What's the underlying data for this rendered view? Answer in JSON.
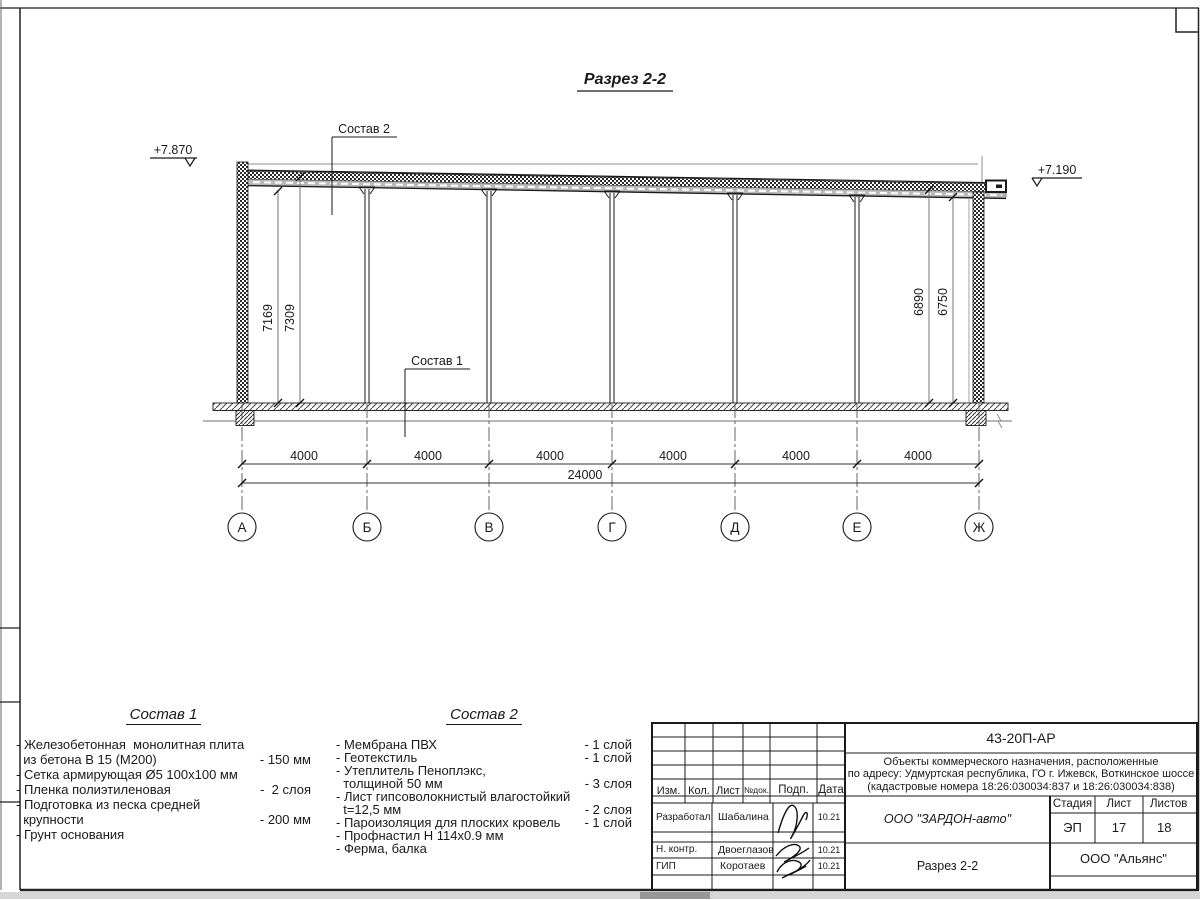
{
  "drawing": {
    "title": "Разрез 2-2",
    "elevation_left": "+7.870",
    "elevation_right": "+7.190",
    "label_composition2": "Состав 2",
    "label_composition1": "Состав 1",
    "dim_left_inner": "7169",
    "dim_left_outer": "7309",
    "dim_right_inner": "6890",
    "dim_right_outer": "6750",
    "bay_dim": "4000",
    "total_dim": "24000",
    "axes": [
      "А",
      "Б",
      "В",
      "Г",
      "Д",
      "Е",
      "Ж"
    ]
  },
  "composition1": {
    "title": "Состав 1",
    "rows": [
      {
        "text": "- Железобетонная  монолитная плита",
        "amount": ""
      },
      {
        "text": "  из бетона В 15 (М200)",
        "amount": "- 150 мм"
      },
      {
        "text": "- Сетка армирующая Ø5 100х100 мм",
        "amount": ""
      },
      {
        "text": "- Пленка полиэтиленовая",
        "amount": "-  2 слоя"
      },
      {
        "text": "- Подготовка из песка средней",
        "amount": ""
      },
      {
        "text": "  крупности",
        "amount": "- 200 мм"
      },
      {
        "text": "- Грунт основания",
        "amount": ""
      }
    ]
  },
  "composition2": {
    "title": "Состав 2",
    "rows": [
      {
        "text": "- Мембрана ПВХ",
        "amount": "- 1 слой"
      },
      {
        "text": "- Геотекстиль",
        "amount": "- 1 слой"
      },
      {
        "text": "- Утеплитель Пеноплэкс,",
        "amount": ""
      },
      {
        "text": "  толщиной 50 мм",
        "amount": "- 3 слоя"
      },
      {
        "text": "- Лист гипсоволокнистый влагостойкий",
        "amount": ""
      },
      {
        "text": "  t=12,5 мм",
        "amount": "- 2 слоя"
      },
      {
        "text": "- Пароизоляция для плоских кровель",
        "amount": "- 1 слой"
      },
      {
        "text": "- Профнастил Н 114х0.9 мм",
        "amount": ""
      },
      {
        "text": "- Ферма, балка",
        "amount": ""
      }
    ]
  },
  "titleblock": {
    "doc_number": "43-20П-АР",
    "project_line1": "Объекты коммерческого назначения, расположенные",
    "project_line2": "по адресу: Удмуртская республика, ГО г. Ижевск, Воткинское шоссе",
    "project_line3": "(кадастровые номера 18:26:030034:837 и 18:26:030034:838)",
    "header_cols": [
      "Изм.",
      "Кол.",
      "Лист",
      "№док.",
      "Подп.",
      "Дата"
    ],
    "rows": [
      {
        "role": "Разработал",
        "name": "Шабалина",
        "date": "10.21"
      },
      {
        "role": "Н. контр.",
        "name": "Двоеглазов",
        "date": "10.21"
      },
      {
        "role": "ГИП",
        "name": "Коротаев",
        "date": "10.21"
      }
    ],
    "company": "ООО \"ЗАРДОН-авто\"",
    "section_title": "Разрез 2-2",
    "stage_label": "Стадия",
    "sheet_label": "Лист",
    "sheets_label": "Листов",
    "stage": "ЭП",
    "sheet": "17",
    "sheets": "18",
    "contractor": "ООО \"Альянс\""
  }
}
